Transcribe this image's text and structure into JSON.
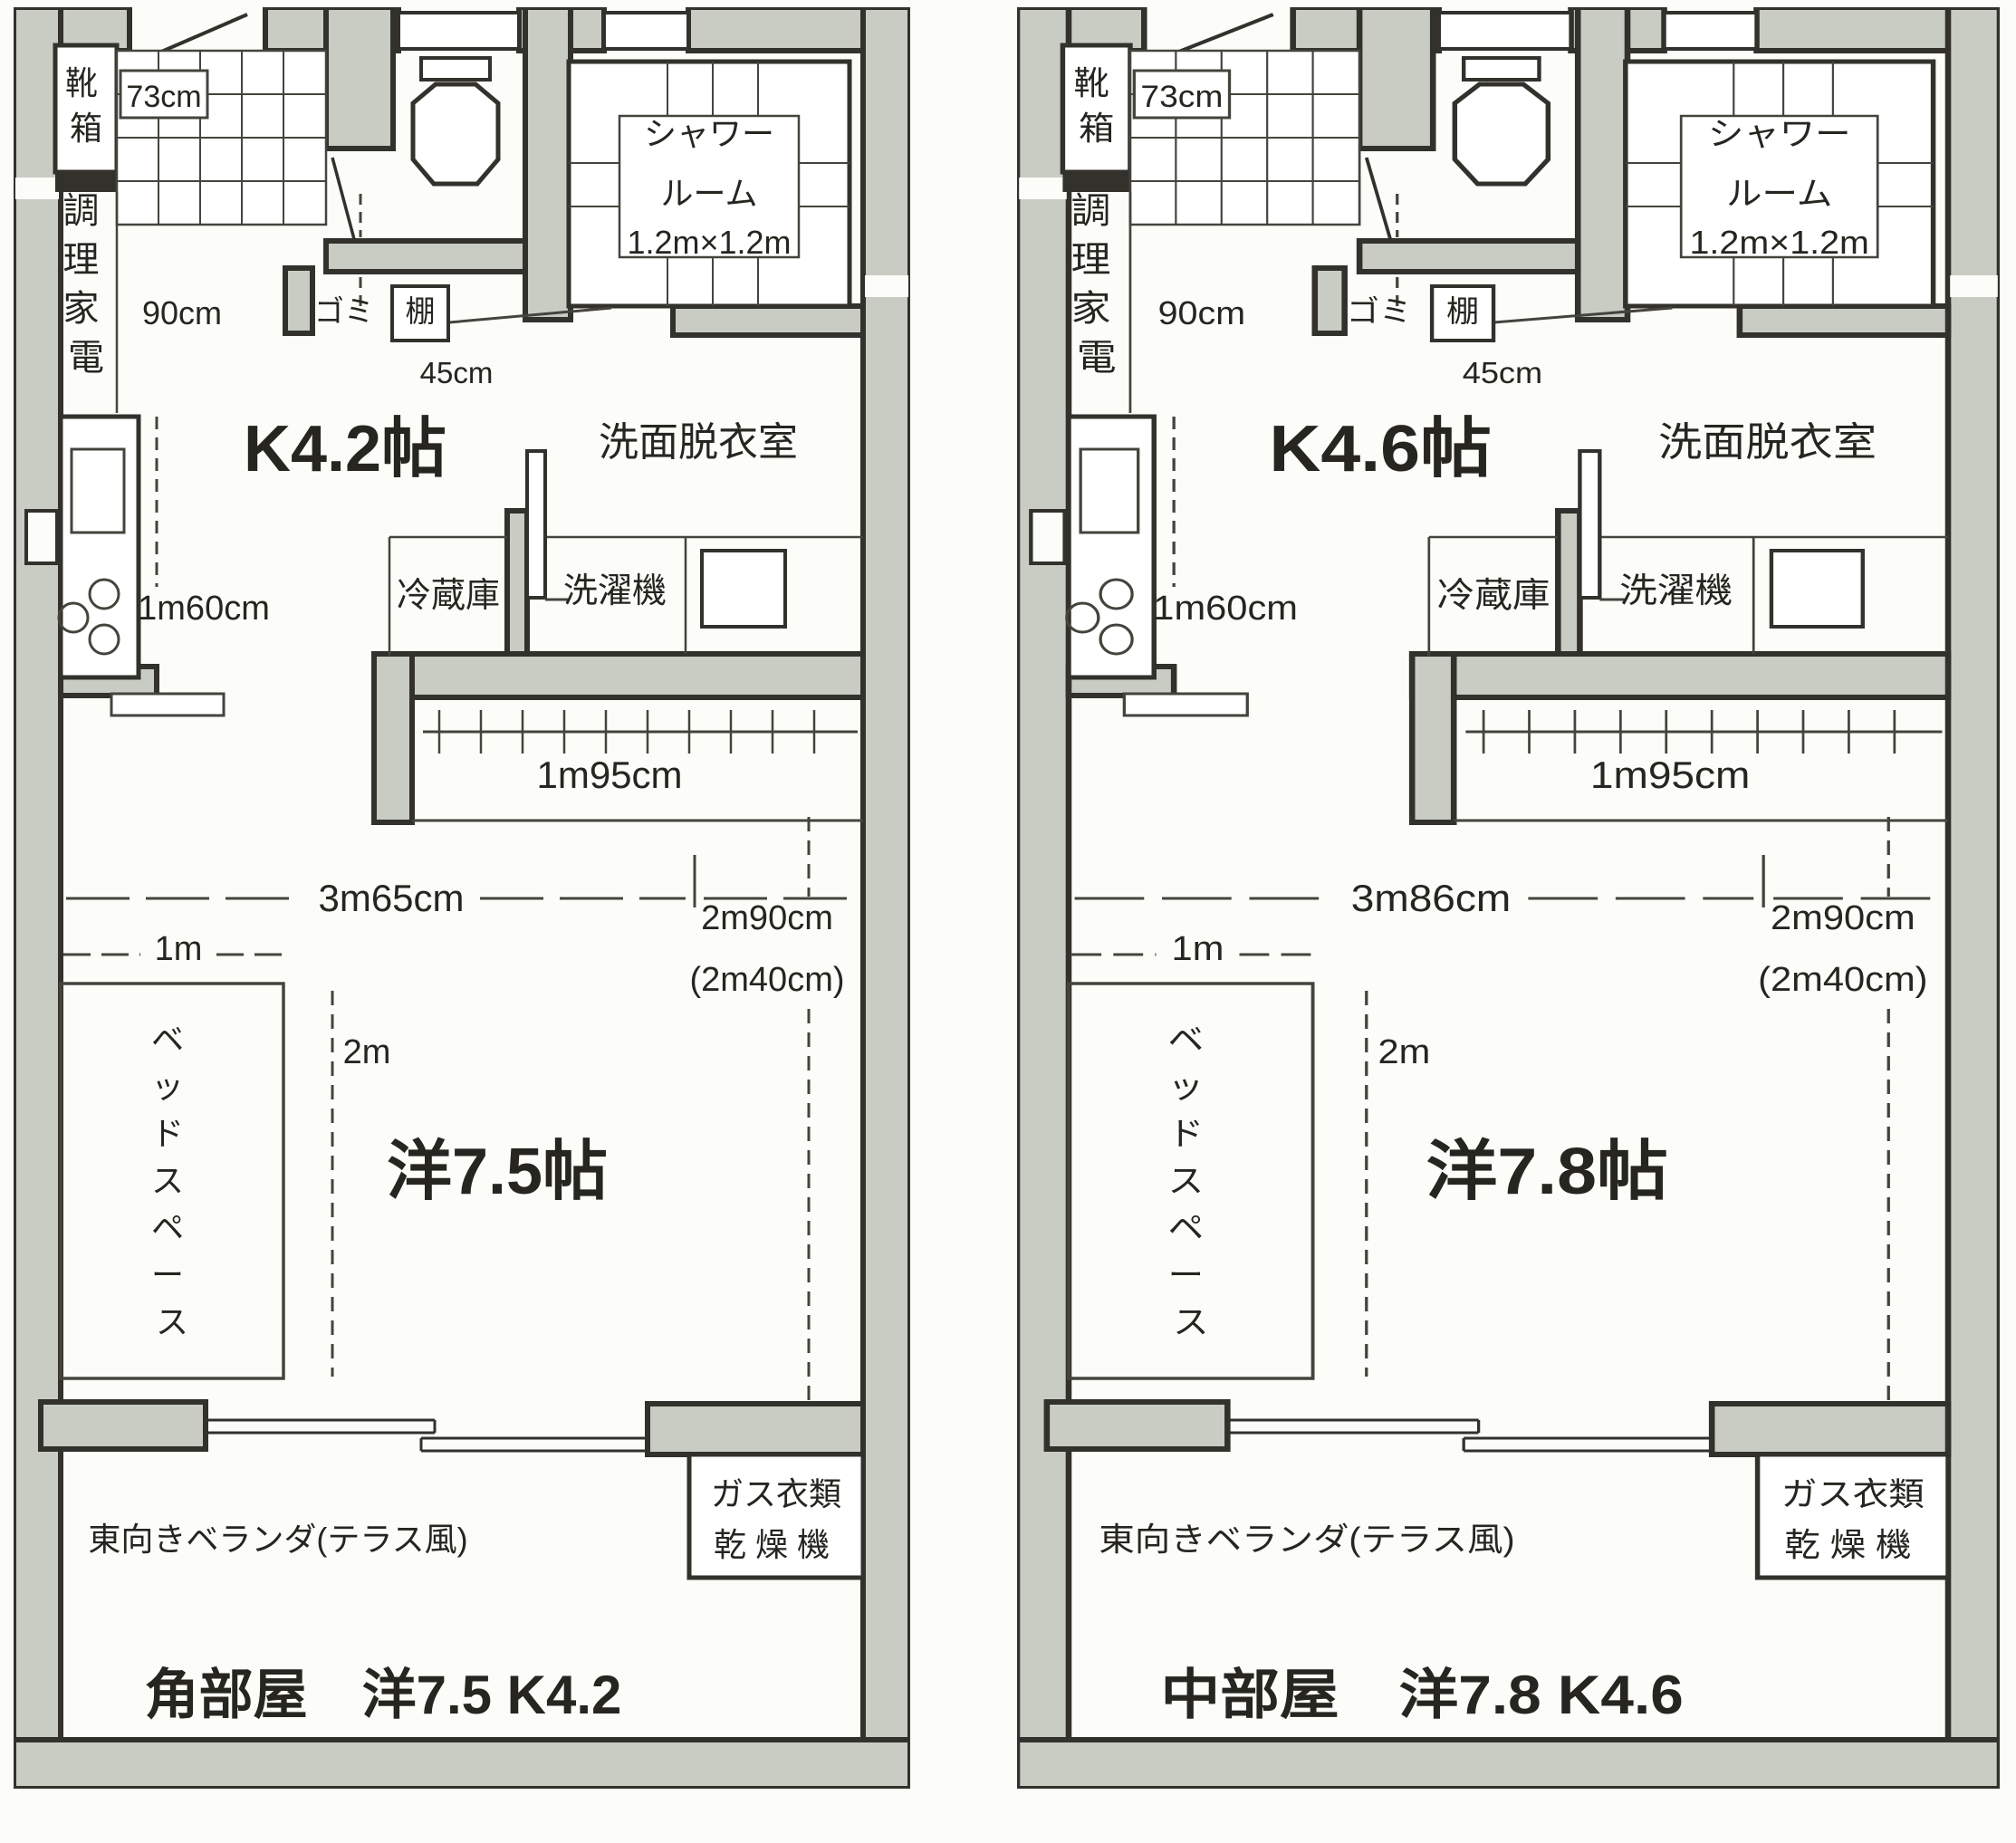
{
  "sheet": {
    "description": "Japanese apartment floor plans, two units side by side"
  },
  "colors": {
    "paper": "#fcfcf9",
    "wall_fill": "#c8ccc3",
    "outline": "#32312b",
    "text": "#26251f"
  },
  "plans": [
    {
      "id": "corner-unit",
      "title": "角部屋　洋7.5 K4.2",
      "labels": {
        "shoe_box": [
          "靴",
          "箱"
        ],
        "entry_width": "73cm",
        "appliance": [
          "調",
          "理",
          "家",
          "電"
        ],
        "corridor_width": "90cm",
        "trash": "ゴミ",
        "shelf": "棚",
        "shelf_width": "45cm",
        "kitchen": "K4.2帖",
        "shower": [
          "シャワー",
          "ルーム",
          "1.2m×1.2m"
        ],
        "washroom": "洗面脱衣室",
        "fridge": "冷蔵庫",
        "washer": "洗濯機",
        "counter_length": "1m60cm",
        "closet_length": "1m95cm",
        "room_width": "3m65cm",
        "bed_width": "1m",
        "bed_length": "2m",
        "room_length": "2m90cm",
        "room_length_alt": "(2m40cm)",
        "bed_space": [
          "ベ",
          "ッ",
          "ド",
          "ス",
          "ペ",
          "ー",
          "ス"
        ],
        "room": "洋7.5帖",
        "dryer_line1": "ガス衣類",
        "dryer_line2": "乾燥機",
        "veranda": "東向きベランダ(テラス風)"
      }
    },
    {
      "id": "middle-unit",
      "title": "中部屋　洋7.8 K4.6",
      "labels": {
        "shoe_box": [
          "靴",
          "箱"
        ],
        "entry_width": "73cm",
        "appliance": [
          "調",
          "理",
          "家",
          "電"
        ],
        "corridor_width": "90cm",
        "trash": "ゴミ",
        "shelf": "棚",
        "shelf_width": "45cm",
        "kitchen": "K4.6帖",
        "shower": [
          "シャワー",
          "ルーム",
          "1.2m×1.2m"
        ],
        "washroom": "洗面脱衣室",
        "fridge": "冷蔵庫",
        "washer": "洗濯機",
        "counter_length": "1m60cm",
        "closet_length": "1m95cm",
        "room_width": "3m86cm",
        "bed_width": "1m",
        "bed_length": "2m",
        "room_length": "2m90cm",
        "room_length_alt": "(2m40cm)",
        "bed_space": [
          "ベ",
          "ッ",
          "ド",
          "ス",
          "ペ",
          "ー",
          "ス"
        ],
        "room": "洋7.8帖",
        "dryer_line1": "ガス衣類",
        "dryer_line2": "乾燥機",
        "veranda": "東向きベランダ(テラス風)"
      }
    }
  ]
}
